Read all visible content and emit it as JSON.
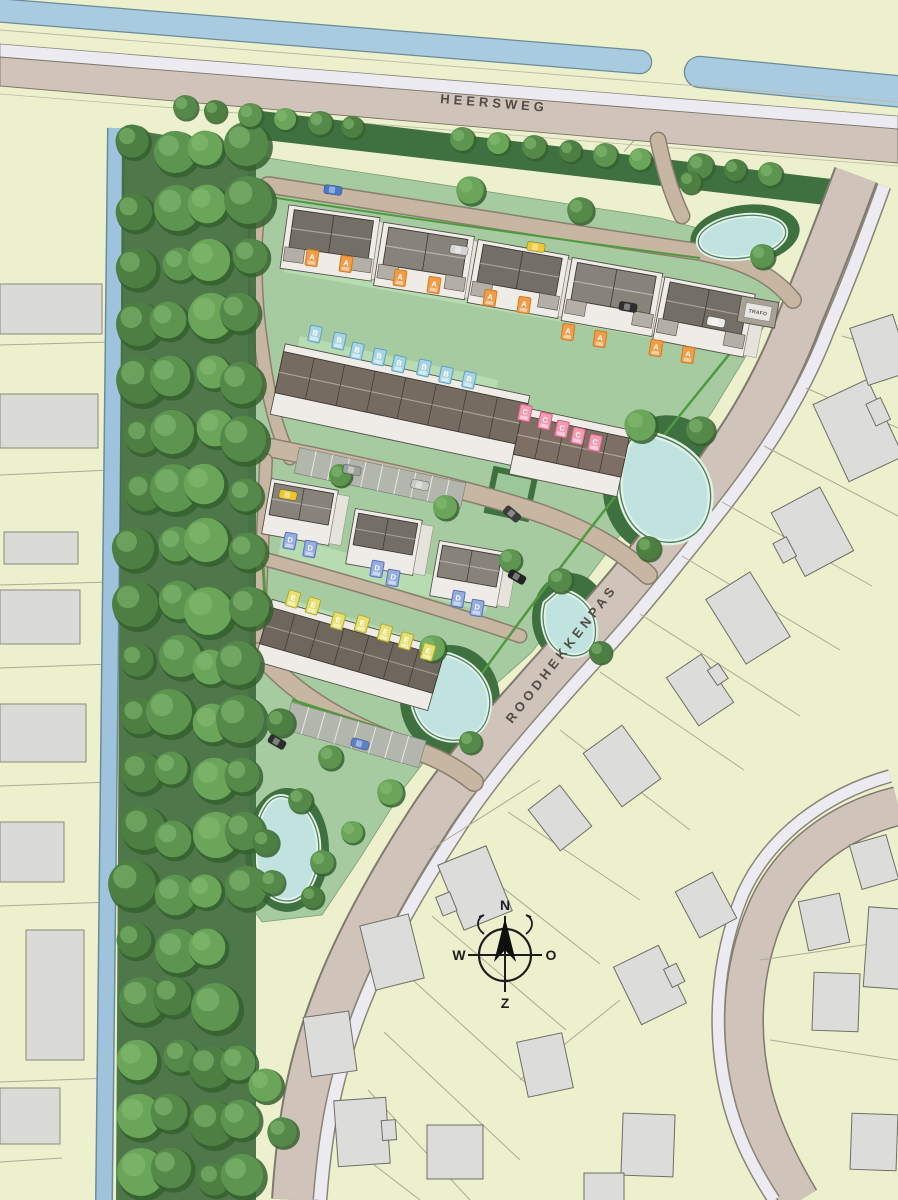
{
  "map": {
    "streets": {
      "heersweg": "HEERSWEG",
      "roodhekkenpas": "ROODHEKKENPAS"
    },
    "signs": {
      "trafo": "TRAFO"
    },
    "compass": {
      "north": "N",
      "east": "O",
      "south": "Z",
      "west": "W"
    },
    "house_types": [
      {
        "code": "A",
        "count": 10,
        "tag_color": "#f09d4a",
        "tag_border": "#d47c1e",
        "label_text_color": "#ffffff"
      },
      {
        "code": "B",
        "count": 8,
        "tag_color": "#aad4e4",
        "tag_border": "#5da3c0",
        "label_text_color": "#ffffff"
      },
      {
        "code": "C",
        "count": 5,
        "tag_color": "#f19cb2",
        "tag_border": "#d55f87",
        "label_text_color": "#ffffff"
      },
      {
        "code": "D",
        "count": 6,
        "tag_color": "#96aede",
        "tag_border": "#5a72bc",
        "label_text_color": "#ffffff"
      },
      {
        "code": "E",
        "count": 7,
        "tag_color": "#e6e070",
        "tag_border": "#b0a832",
        "label_text_color": "#ffffff"
      }
    ],
    "colors": {
      "background": "#edf0cc",
      "water": "#a9cbdf",
      "pond": "#c0e3e0",
      "road_main": "#cfc3ba",
      "road_site": "#c6b6a2",
      "path_white": "#edebf2",
      "site_green": "#a6cba1",
      "green_dark": "#3f7040",
      "garden_green": "#b7dcb2",
      "hedge": "#4f9a3f",
      "roof_dark": "#6f675e",
      "roof_mid": "#87827a",
      "building_existing": "#dcdcda",
      "trees": [
        "#4c7f41",
        "#5c9450",
        "#6aa55a",
        "#55894a"
      ],
      "tree_highlight": "#86bd74"
    }
  }
}
